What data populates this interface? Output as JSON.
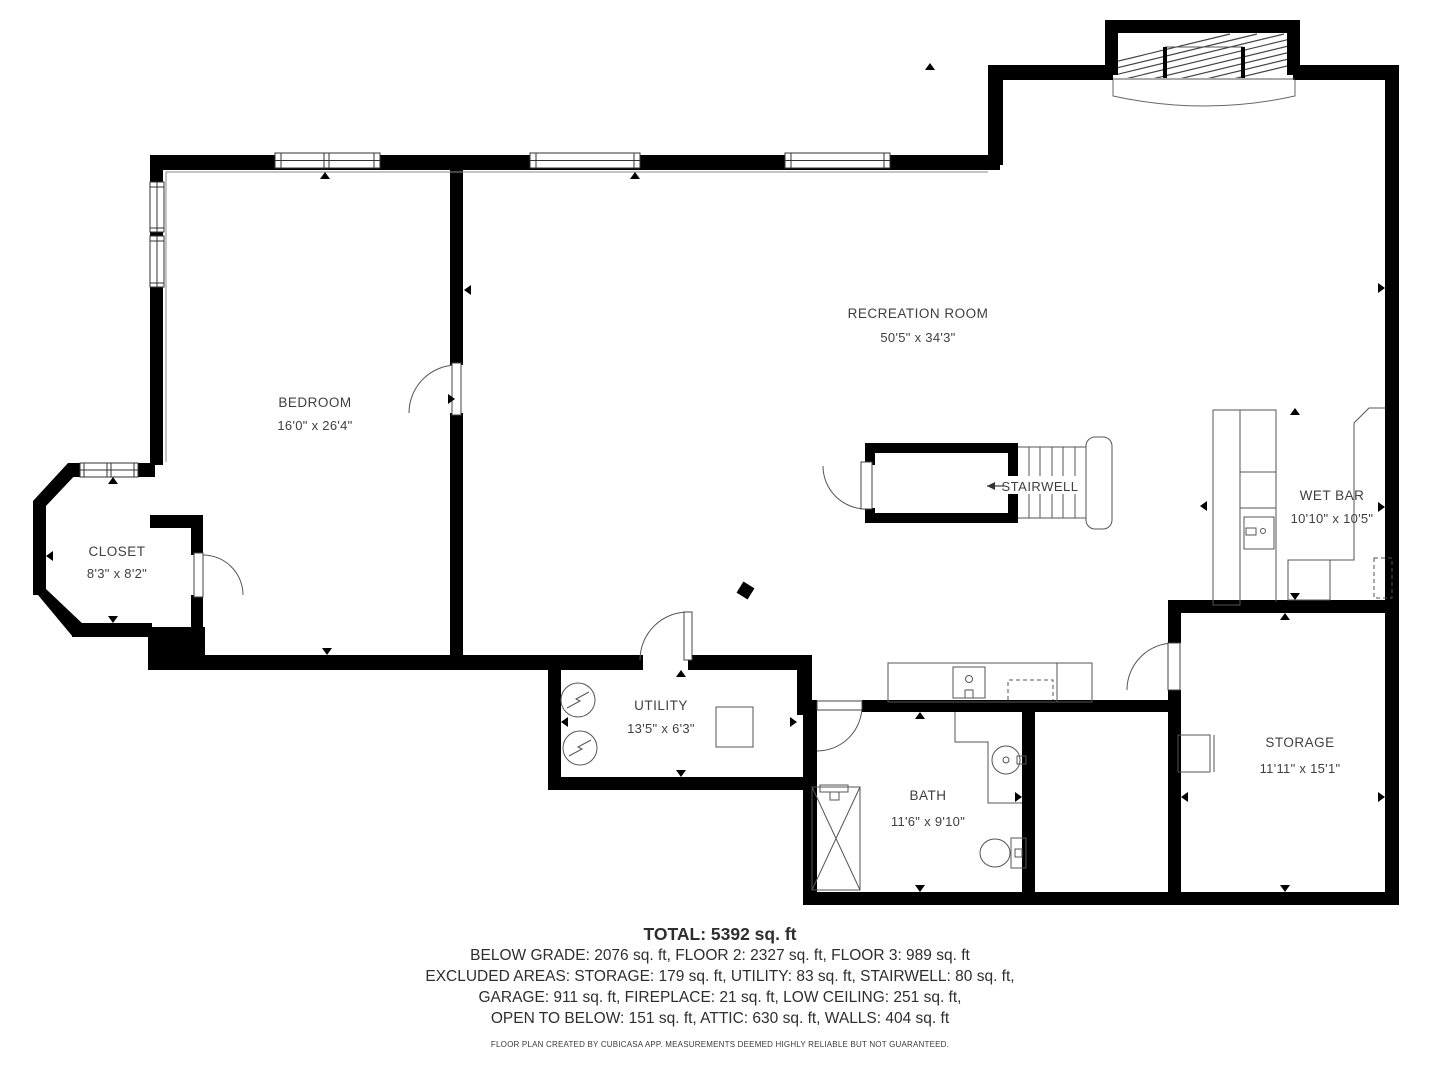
{
  "rooms": {
    "bedroom": {
      "name": "BEDROOM",
      "dims": "16'0\" x 26'4\""
    },
    "closet": {
      "name": "CLOSET",
      "dims": "8'3\" x 8'2\""
    },
    "recreation": {
      "name": "RECREATION ROOM",
      "dims": "50'5\" x 34'3\""
    },
    "stairwell": {
      "name": "STAIRWELL"
    },
    "wetbar": {
      "name": "WET BAR",
      "dims": "10'10\" x 10'5\""
    },
    "utility": {
      "name": "UTILITY",
      "dims": "13'5\" x 6'3\""
    },
    "bath": {
      "name": "BATH",
      "dims": "11'6\" x 9'10\""
    },
    "storage": {
      "name": "STORAGE",
      "dims": "11'11\" x 15'1\""
    }
  },
  "summary": {
    "total": "TOTAL: 5392 sq. ft",
    "line1": "BELOW GRADE: 2076 sq. ft, FLOOR 2: 2327 sq. ft, FLOOR 3: 989 sq. ft",
    "line2": "EXCLUDED AREAS: STORAGE: 179 sq. ft, UTILITY: 83 sq. ft, STAIRWELL: 80 sq. ft,",
    "line3": "GARAGE: 911 sq. ft, FIREPLACE: 21 sq. ft, LOW CEILING: 251 sq. ft,",
    "line4": "OPEN TO BELOW: 151 sq. ft, ATTIC: 630 sq. ft, WALLS: 404 sq. ft",
    "footer": "FLOOR PLAN CREATED BY CUBICASA APP. MEASUREMENTS DEEMED HIGHLY RELIABLE BUT NOT GUARANTEED."
  },
  "colors": {
    "wall": "#000000",
    "line": "#555555",
    "text": "#3f3f3f"
  }
}
